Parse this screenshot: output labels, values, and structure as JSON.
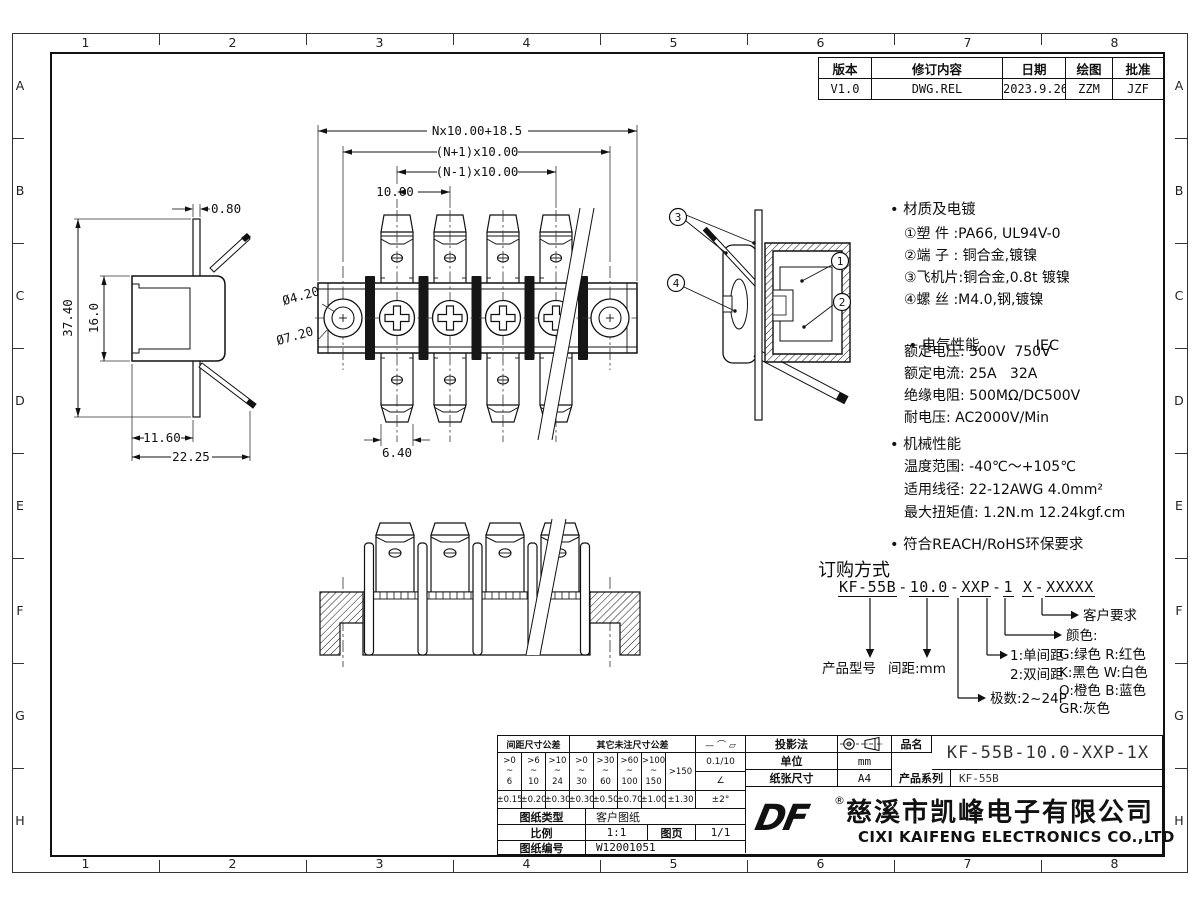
{
  "border": {
    "cols": [
      "1",
      "2",
      "3",
      "4",
      "5",
      "6",
      "7",
      "8"
    ],
    "rows": [
      "A",
      "B",
      "C",
      "D",
      "E",
      "F",
      "G",
      "H"
    ]
  },
  "rev": {
    "headers": [
      "版本",
      "修订内容",
      "日期",
      "绘图",
      "批准"
    ],
    "values": [
      "V1.0",
      "DWG.REL",
      "2023.9.26",
      "ZZM",
      "JZF"
    ]
  },
  "fv": {
    "dim_total": "Nx10.00+18.5",
    "dim_n_plus": "(N+1)x10.00",
    "dim_n_minus": "(N-1)x10.00",
    "dim_pitch": "10.00",
    "hole_small": "Ø4.20",
    "hole_big": "Ø7.20",
    "tab_width": "6.40"
  },
  "lv": {
    "thickness": "0.80",
    "height": "37.40",
    "body_h": "16.0",
    "depth1": "11.60",
    "depth2": "22.25"
  },
  "sv": {
    "c1": "1",
    "c2": "2",
    "c3": "3",
    "c4": "4"
  },
  "specs": {
    "material": {
      "title": "• 材质及电镀",
      "lines": [
        "①塑 件 :PA66, UL94V-0",
        "②端 子 : 铜合金,镀镍",
        "③飞机片:铜合金,0.8t 镀镍",
        "④螺 丝 :M4.0,钢,镀镍"
      ]
    },
    "electrical": {
      "title": "• 电气性能",
      "standard": "IEC",
      "lines": [
        "额定电压: 300V  750V",
        "额定电流: 25A   32A",
        "绝缘电阻: 500MΩ/DC500V",
        "耐电压: AC2000V/Min"
      ]
    },
    "mechanical": {
      "title": "• 机械性能",
      "lines": [
        "温度范围: -40℃～+105℃",
        "适用线径: 22-12AWG 4.0mm²",
        "最大扭矩值: 1.2N.m 12.24kgf.cm"
      ]
    },
    "compliance": "• 符合REACH/RoHS环保要求"
  },
  "ordering": {
    "title": "订购方式",
    "segments": [
      "KF-55B",
      "10.0",
      "XXP",
      "1",
      "X",
      "XXXXX"
    ],
    "sep": "-",
    "labels": {
      "model": "产品型号",
      "pitch": "间距:mm",
      "poles": "极数:2~24P",
      "opt1": "1:单间距",
      "opt2": "2:双间距",
      "color_title": "颜色:",
      "colors": [
        "G:绿色  R:红色",
        "K:黑色  W:白色",
        "O:橙色  B:蓝色",
        "GR:灰色"
      ],
      "custom": "客户要求"
    }
  },
  "tb": {
    "header_pitch": "间距尺寸公差",
    "header_other": "其它未注尺寸公差",
    "symbols": "— ⌒ ▱",
    "flatness": "0.1/10",
    "angle_symbol": "∠",
    "angle_tol": "±2°",
    "ranges": [
      ">0\n~\n6",
      ">6\n~\n10",
      ">10\n~\n24",
      ">0\n~\n30",
      ">30\n~\n60",
      ">60\n~\n100",
      ">100\n~\n150",
      ">150"
    ],
    "tols": [
      "±0.15",
      "±0.20",
      "±0.30",
      "±0.30",
      "±0.50",
      "±0.70",
      "±1.00",
      "±1.30"
    ],
    "doc_type_label": "图纸类型",
    "doc_type": "客户图纸",
    "scale_label": "比例",
    "scale": "1:1",
    "sheet_label": "图页",
    "sheet": "1/1",
    "number_label": "图纸编号",
    "number": "W12001051",
    "projection_label": "投影法",
    "unit_label": "单位",
    "unit": "mm",
    "paper_label": "纸张尺寸",
    "paper": "A4",
    "part_label": "品名",
    "part": "KF-55B-10.0-XXP-1X",
    "series_label": "产品系列",
    "series": "KF-55B",
    "logo": "DF",
    "reg": "®",
    "company_cn": "慈溪市凯峰电子有限公司",
    "company_en": "CIXI KAIFENG ELECTRONICS CO.,LTD"
  }
}
